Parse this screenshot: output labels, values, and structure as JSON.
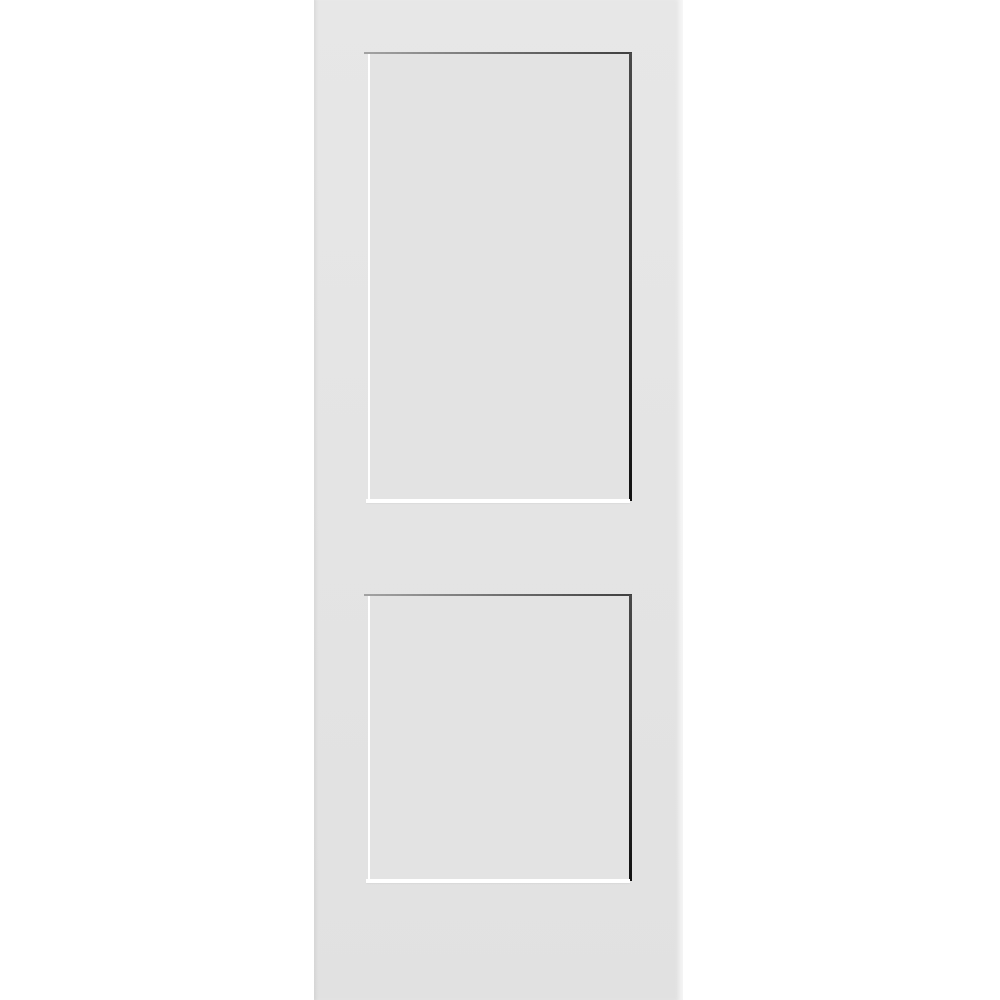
{
  "scene": {
    "subject": "white-two-panel-shaker-interior-door",
    "background_color": "#ffffff",
    "door": {
      "face_color_top": "#e7e7e7",
      "face_color_bottom": "#e1e1e1"
    },
    "panels": {
      "count": "2",
      "face_color": "#e3e3e3",
      "shadow_top_color_left": "#a3a3a3",
      "shadow_top_color_right": "#3f3f3f",
      "shadow_right_color_top": "#4a4a4a",
      "shadow_right_color_bottom": "#121212",
      "highlight_color": "#ffffff"
    }
  }
}
